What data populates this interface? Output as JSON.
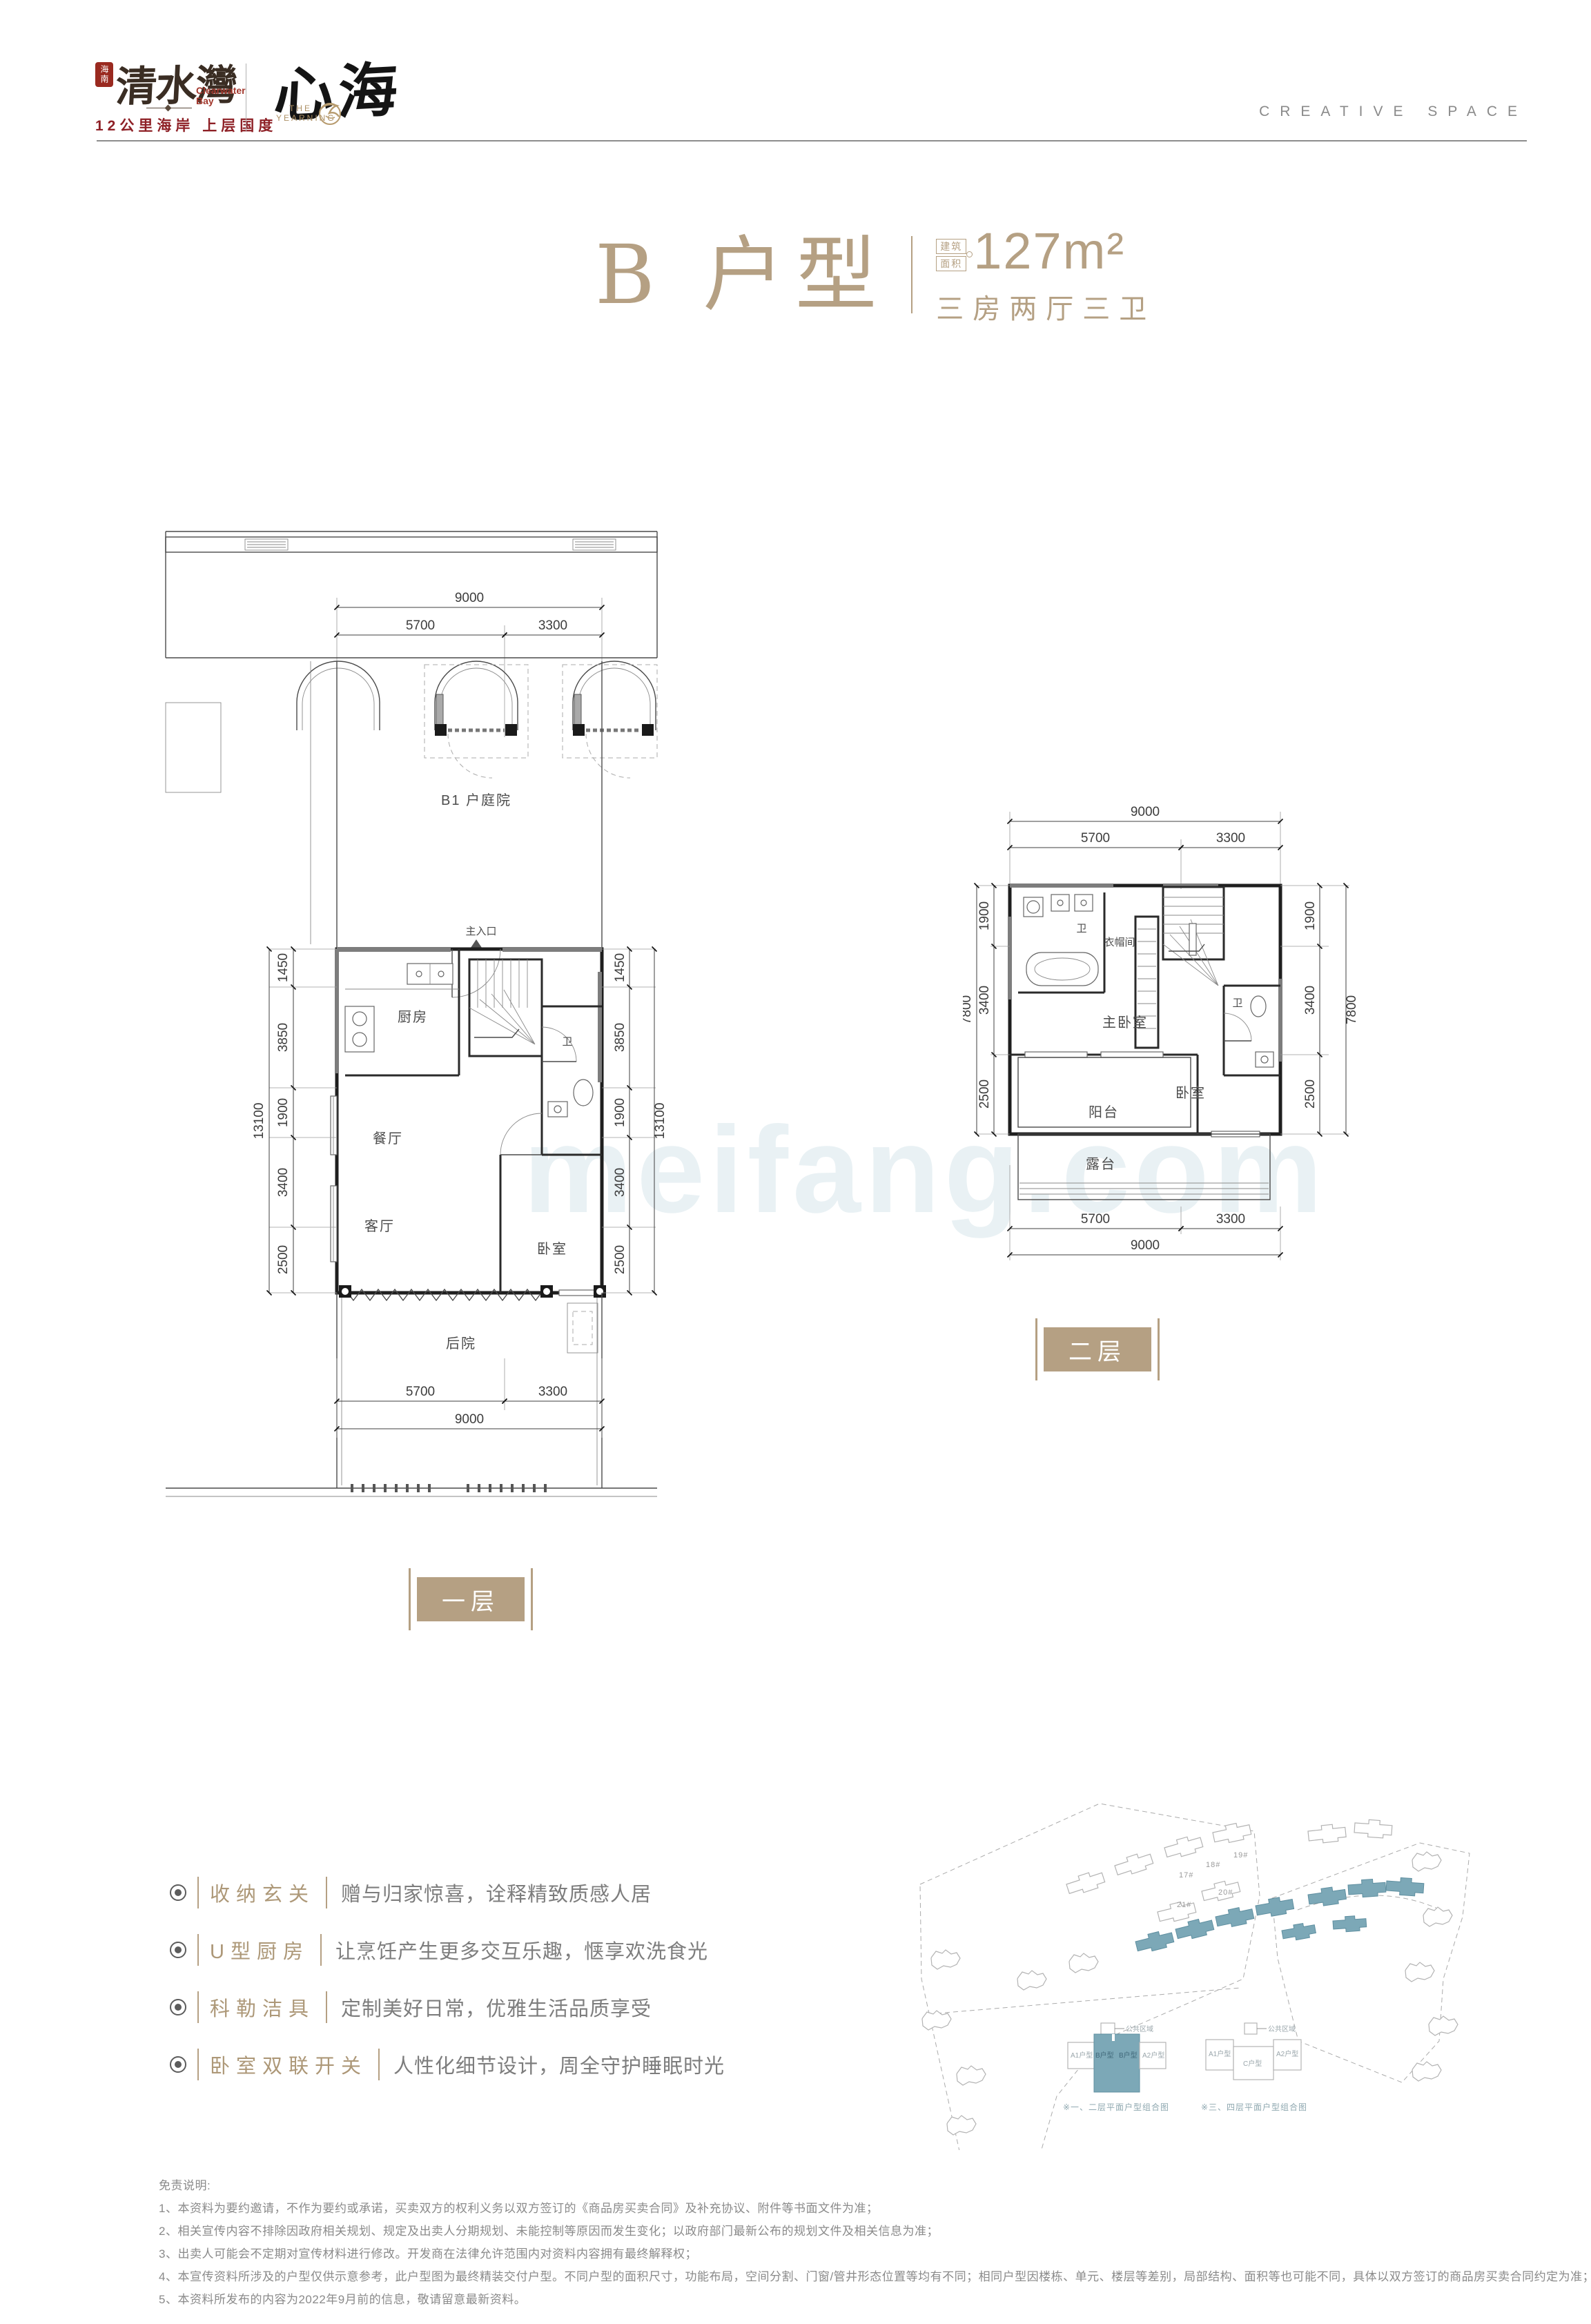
{
  "colors": {
    "accent": "#b5a083",
    "brand_red": "#8e2026",
    "site_teal": "#7ca8b7"
  },
  "header": {
    "brand_left": {
      "seal": "海南",
      "name": "清水灣",
      "en1": "Clearwater",
      "en2": "Bay",
      "tagline": "12公里海岸 上层国度"
    },
    "brand_right": {
      "name": "心海",
      "sub1": "THE",
      "sub2": "YEARNING"
    },
    "creative": "CREATIVE SPACE"
  },
  "title": {
    "unit": "B 户型",
    "area_label_1": "建筑",
    "area_label_2": "面积",
    "area_value": "127m²",
    "layout": "三房两厅三卫"
  },
  "watermark": "meifang.com",
  "plan1": {
    "badge": "一层",
    "rooms": {
      "entrance": "主入口",
      "courtyard": "B1 户庭院",
      "kitchen": "厨房",
      "dining": "餐厅",
      "living": "客厅",
      "bedroom": "卧室",
      "bath": "卫",
      "backyard": "后院"
    },
    "dims": {
      "t9000": "9000",
      "t5700": "5700",
      "t3300": "3300",
      "v": [
        "1450",
        "3850",
        "1900",
        "3400",
        "2500"
      ],
      "vt": "13100"
    }
  },
  "plan2": {
    "badge": "二层",
    "rooms": {
      "bath1": "卫",
      "cloak": "衣帽间",
      "master": "主卧室",
      "bath2": "卫",
      "bedroom": "卧室",
      "balcony": "阳台",
      "terrace": "露台"
    },
    "dims": {
      "t9000": "9000",
      "t5700": "5700",
      "t3300": "3300",
      "v": [
        "1900",
        "3400",
        "2500"
      ],
      "vt": "7800"
    }
  },
  "features": [
    {
      "title": "收纳玄关",
      "desc": "赠与归家惊喜，诠释精致质感人居"
    },
    {
      "title": "U型厨房",
      "desc": "让烹饪产生更多交互乐趣，惬享欢洗食光"
    },
    {
      "title": "科勒洁具",
      "desc": "定制美好日常，优雅生活品质享受"
    },
    {
      "title": "卧室双联开关",
      "desc": "人性化细节设计，周全守护睡眠时光"
    }
  ],
  "siteplan": {
    "labels": [
      "17#",
      "18#",
      "19#",
      "20#",
      "21#"
    ],
    "d1": {
      "a1": "A1户型",
      "b": "B户型",
      "a2": "A2户型",
      "common": "公共区域",
      "caption": "※一、二层平面户型组合图"
    },
    "d2": {
      "a1": "A1户型",
      "c": "C户型",
      "a2": "A2户型",
      "common": "公共区域",
      "caption": "※三、四层平面户型组合图"
    }
  },
  "disclaimer": {
    "title": "免责说明:",
    "lines": [
      "1、本资料为要约邀请，不作为要约或承诺，买卖双方的权利义务以双方签订的《商品房买卖合同》及补充协议、附件等书面文件为准；",
      "2、相关宣传内容不排除因政府相关规划、规定及出卖人分期规划、未能控制等原因而发生变化；以政府部门最新公布的规划文件及相关信息为准；",
      "3、出卖人可能会不定期对宣传材料进行修改。开发商在法律允许范围内对资料内容拥有最终解释权；",
      "4、本宣传资料所涉及的户型仅供示意参考，此户型图为最终精装交付户型。不同户型的面积尺寸，功能布局，空间分割、门窗/管井形态位置等均有不同；相同户型因楼栋、单元、楼层等差别，局部结构、面积等也可能不同，具体以双方签订的商品房买卖合同约定为准；",
      "5、本资料所发布的内容为2022年9月前的信息，敬请留意最新资料。"
    ]
  }
}
